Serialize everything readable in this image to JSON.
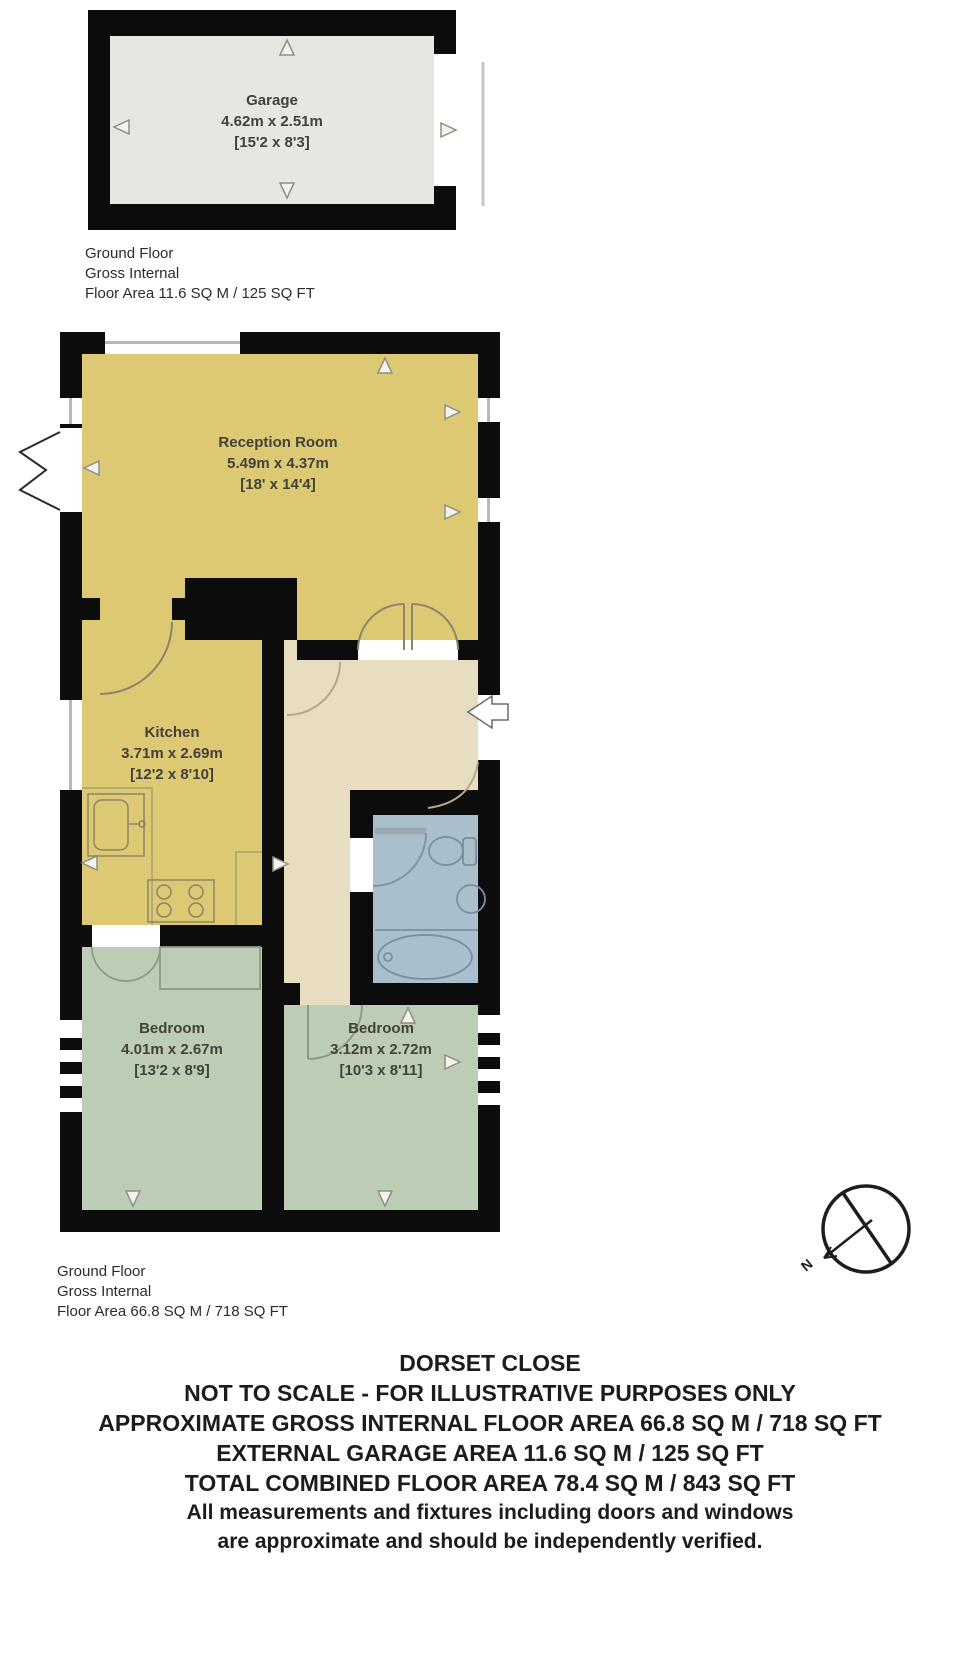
{
  "garage": {
    "name": "Garage",
    "metric": "4.62m x 2.51m",
    "imperial": "[15'2 x 8'3]"
  },
  "garage_floor_label": {
    "line1": "Ground Floor",
    "line2": "Gross Internal",
    "line3": "Floor Area 11.6 SQ M / 125 SQ FT"
  },
  "rooms": {
    "reception": {
      "name": "Reception Room",
      "metric": "5.49m x 4.37m",
      "imperial": "[18' x 14'4]"
    },
    "kitchen": {
      "name": "Kitchen",
      "metric": "3.71m x 2.69m",
      "imperial": "[12'2 x 8'10]"
    },
    "bedroom_left": {
      "name": "Bedroom",
      "metric": "4.01m x 2.67m",
      "imperial": "[13'2 x 8'9]"
    },
    "bedroom_right": {
      "name": "Bedroom",
      "metric": "3.12m x 2.72m",
      "imperial": "[10'3 x 8'11]"
    }
  },
  "main_floor_label": {
    "line1": "Ground Floor",
    "line2": "Gross Internal",
    "line3": "Floor Area 66.8 SQ M / 718 SQ FT"
  },
  "compass": {
    "label": "N"
  },
  "footer": {
    "lines": [
      "DORSET CLOSE",
      "NOT TO SCALE - FOR ILLUSTRATIVE PURPOSES ONLY",
      "APPROXIMATE GROSS INTERNAL FLOOR AREA 66.8 SQ M / 718 SQ FT",
      "EXTERNAL GARAGE AREA 11.6 SQ M / 125 SQ FT",
      "TOTAL COMBINED FLOOR AREA 78.4 SQ M / 843 SQ FT",
      "All measurements and fixtures including doors and windows",
      "are approximate and should be independently verified."
    ]
  },
  "colors": {
    "walls": "#0c0c0c",
    "reception_kitchen": "#ddc873",
    "hallway": "#e8ddc1",
    "bathroom": "#a9bfcb",
    "bedrooms": "#bdccb4",
    "garage": "#e6e6e2",
    "page_background": "#ffffff"
  }
}
